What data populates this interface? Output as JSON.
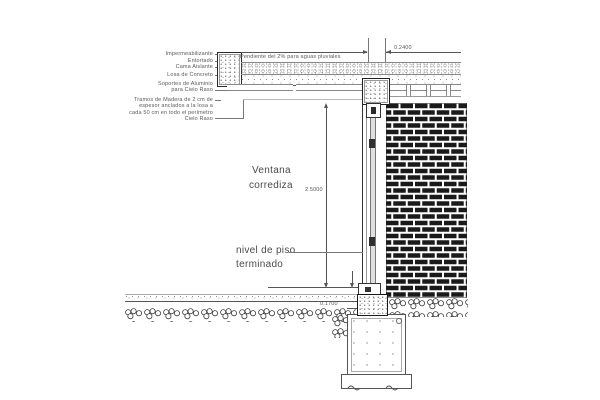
{
  "annotations": {
    "layers": {
      "impermeabilizante": "Impermeabilizante",
      "entortado": "Entortado",
      "cama_aislante": "Cama Aislante",
      "losa_concreto": "Losa de Concreto",
      "soportes_1": "Soportes de Aluminio",
      "soportes_2": "para Cielo Raso",
      "tramos_1": "Tramos de Madera de 2 cm de",
      "tramos_2": "espesor anclados a la losa a",
      "tramos_3": "cada 50 cm en todo el perímetro",
      "cielo_raso": "Cielo Raso"
    },
    "pendiente": "Pendiente del 2% para aguas pluviales",
    "ventana_1": "Ventana",
    "ventana_2": "corrediza",
    "nivel_1": "nivel de piso",
    "nivel_2": "terminado"
  },
  "dimensions": {
    "parapet_width": "0.2400",
    "window_height": "2.5000",
    "sill_offset": "0.1700"
  },
  "colors": {
    "line": "#555555",
    "brick": "#1a1a1a",
    "speckle": "#8a8a8a",
    "background": "#ffffff"
  }
}
